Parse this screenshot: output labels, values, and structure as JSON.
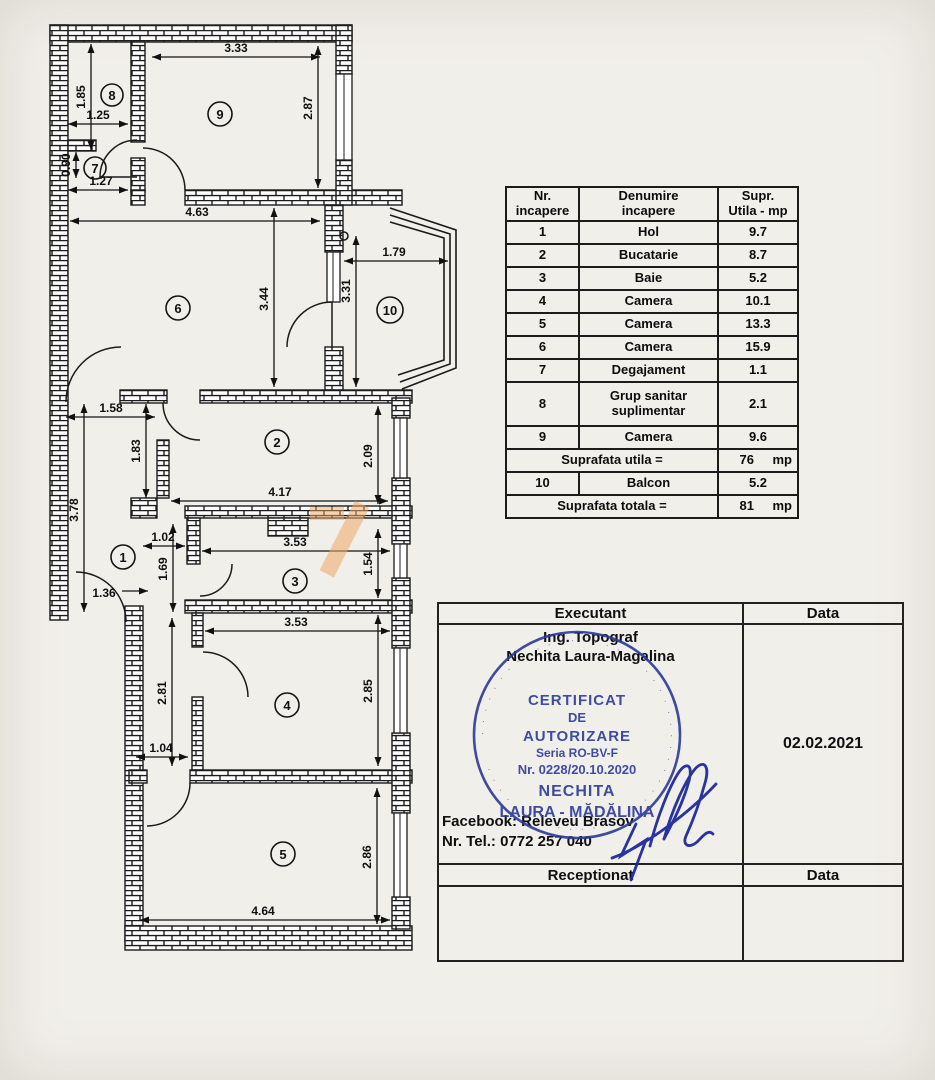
{
  "rooms_table": {
    "col1_l1": "Nr.",
    "col1_l2": "incapere",
    "col2_l1": "Denumire",
    "col2_l2": "incapere",
    "col3_l1": "Supr.",
    "col3_l2": "Utila - mp",
    "rows": [
      {
        "nr": "1",
        "name": "Hol",
        "area": "9.7"
      },
      {
        "nr": "2",
        "name": "Bucatarie",
        "area": "8.7"
      },
      {
        "nr": "3",
        "name": "Baie",
        "area": "5.2"
      },
      {
        "nr": "4",
        "name": "Camera",
        "area": "10.1"
      },
      {
        "nr": "5",
        "name": "Camera",
        "area": "13.3"
      },
      {
        "nr": "6",
        "name": "Camera",
        "area": "15.9"
      },
      {
        "nr": "7",
        "name": "Degajament",
        "area": "1.1"
      },
      {
        "nr": "8",
        "name": "Grup sanitar suplimentar",
        "area": "2.1"
      },
      {
        "nr": "9",
        "name": "Camera",
        "area": "9.6"
      }
    ],
    "utila_label": "Suprafata  utila =",
    "utila_value": "76",
    "utila_unit": "mp",
    "balcon": {
      "nr": "10",
      "name": "Balcon",
      "area": "5.2"
    },
    "totala_label": "Suprafata  totala =",
    "totala_value": "81",
    "totala_unit": "mp"
  },
  "plan": {
    "dims": [
      "3.33",
      "1.25",
      "1.27",
      "4.63",
      "1.79",
      "1.58",
      "4.17",
      "1.02",
      "1.36",
      "3.53",
      "3.53",
      "1.04",
      "4.64",
      "1.85",
      "0.90",
      "2.87",
      "3.44",
      "3.31",
      "1.83",
      "2.09",
      "3.78",
      "1.69",
      "1.54",
      "2.85",
      "2.81",
      "2.86"
    ],
    "rooms": [
      "1",
      "2",
      "3",
      "4",
      "5",
      "6",
      "7",
      "8",
      "9",
      "10"
    ],
    "highlight_color": "#eca866"
  },
  "exec_table": {
    "executant": "Executant",
    "data1": "Data",
    "role": "Ing. Topograf",
    "name": "Nechita Laura-Magalina",
    "facebook": "Facebook: Releveu Brasov",
    "phone": "Nr. Tel.: 0772 257 040",
    "date": "02.02.2021",
    "receptionat": "Receptionat",
    "data2": "Data"
  },
  "stamp": {
    "line1": "CERTIFICAT",
    "line2": "DE",
    "line3": "AUTORIZARE",
    "line4": "Seria RO-BV-F",
    "line5": "Nr. 0228/20.10.2020",
    "line6": "NECHITA",
    "line7": "LAURA - MĂDĂLINA",
    "ring_text": "· · · · · · · · · · · · · · · · · · · · · · · · · · · · · · · · · · · · · · · · · · · · · · · ·",
    "color": "#2b3a98"
  }
}
